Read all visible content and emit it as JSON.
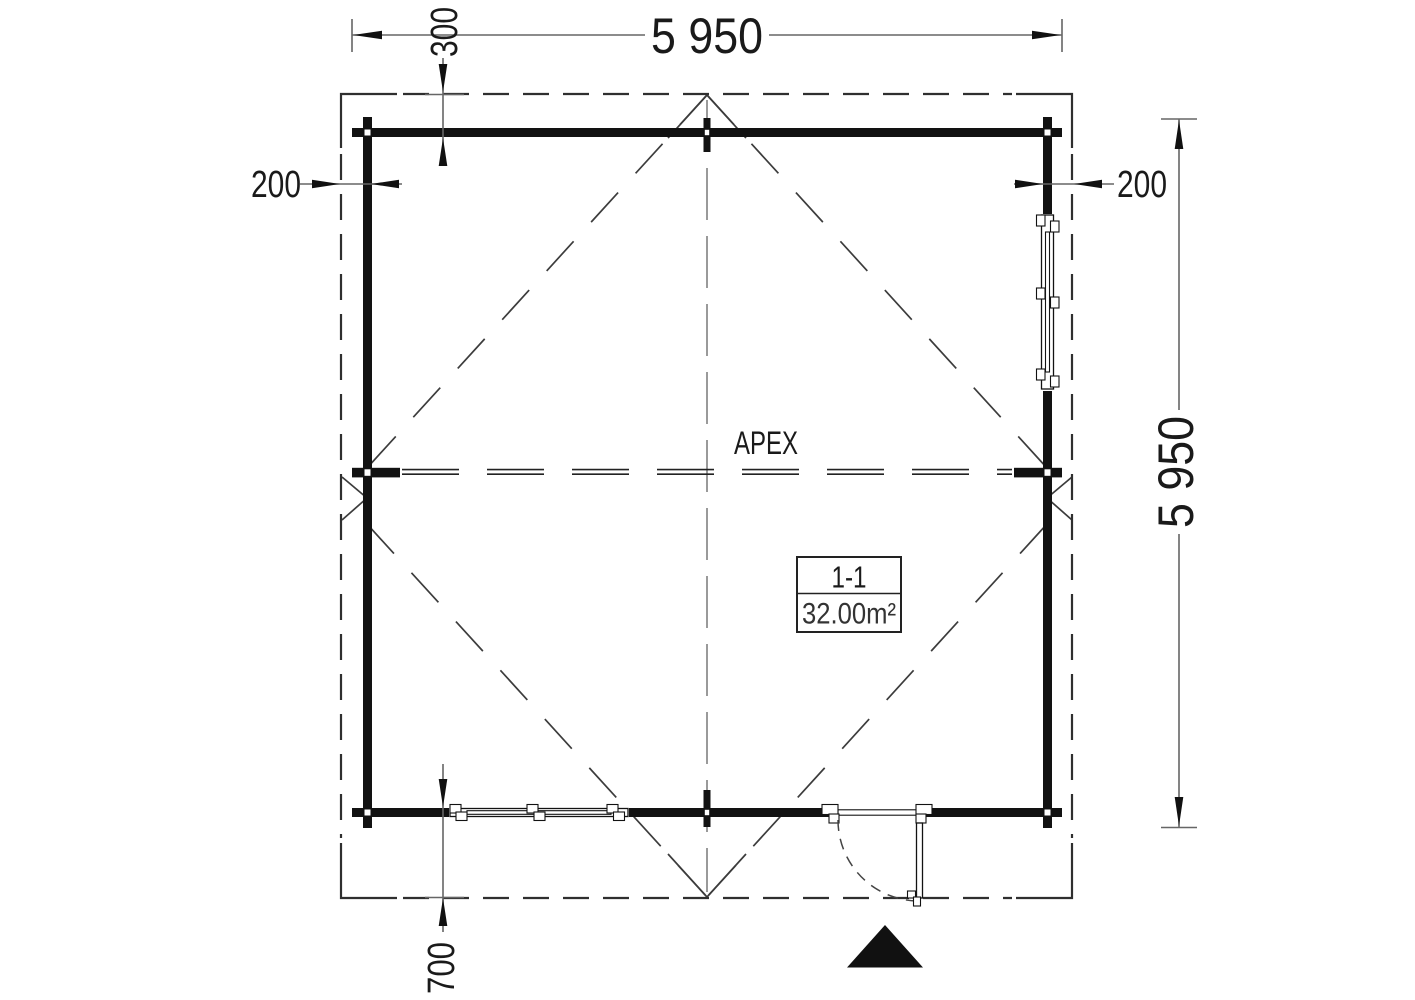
{
  "plan": {
    "dimensions": {
      "top_width": "5 950",
      "right_height": "5 950",
      "top_offset": "300",
      "left_overhang": "200",
      "right_overhang": "200",
      "bottom_overhang": "700"
    },
    "labels": {
      "apex": "APEX",
      "section": "1-1",
      "area": "32.00m²"
    },
    "colors": {
      "background": "#ffffff",
      "wall": "#121212",
      "roof_outline": "#2f2f2f",
      "roof_diagonal": "#3c3c3c",
      "centerline": "#8f8f8f",
      "dimension_line": "#666666",
      "arrow": "#111111",
      "text": "#1a1a1a",
      "secondary_text": "#333333"
    }
  }
}
